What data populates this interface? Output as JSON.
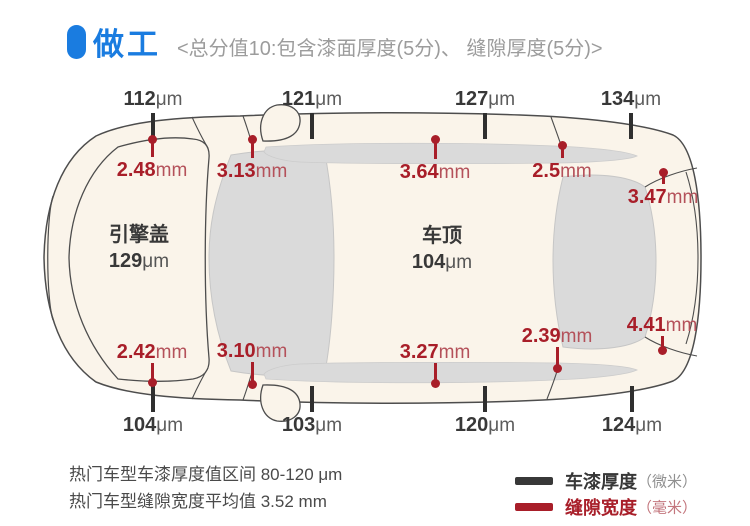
{
  "header": {
    "title": "做工",
    "subtitle": "<总分值10:包含漆面厚度(5分)、 缝隙厚度(5分)>"
  },
  "car": {
    "hood": {
      "name": "引擎盖",
      "value": "129",
      "unit": "μm"
    },
    "roof": {
      "name": "车顶",
      "value": "104",
      "unit": "μm"
    }
  },
  "measurements": {
    "paint_unit": "μm",
    "gap_unit": "mm",
    "paint_top": [
      {
        "value": "112",
        "x": 153
      },
      {
        "value": "121",
        "x": 312
      },
      {
        "value": "127",
        "x": 485
      },
      {
        "value": "134",
        "x": 631
      }
    ],
    "paint_bottom": [
      {
        "value": "104",
        "x": 153
      },
      {
        "value": "103",
        "x": 312
      },
      {
        "value": "120",
        "x": 485
      },
      {
        "value": "124",
        "x": 632
      }
    ],
    "gap_top": [
      {
        "value": "2.48",
        "x": 152,
        "dot_y": 139,
        "label_y": 159
      },
      {
        "value": "3.13",
        "x": 252,
        "dot_y": 139,
        "label_y": 160
      },
      {
        "value": "3.64",
        "x": 435,
        "dot_y": 139,
        "label_y": 161
      },
      {
        "value": "2.5",
        "x": 562,
        "dot_y": 145,
        "label_y": 160
      },
      {
        "value": "3.47",
        "x": 663,
        "dot_y": 172,
        "label_y": 186
      }
    ],
    "gap_bottom": [
      {
        "value": "2.42",
        "x": 152,
        "dot_y": 382,
        "label_y": 341
      },
      {
        "value": "3.10",
        "x": 252,
        "dot_y": 384,
        "label_y": 340
      },
      {
        "value": "3.27",
        "x": 435,
        "dot_y": 383,
        "label_y": 341
      },
      {
        "value": "2.39",
        "x": 557,
        "dot_y": 368,
        "label_y": 325
      },
      {
        "value": "4.41",
        "x": 662,
        "dot_y": 350,
        "label_y": 314
      }
    ]
  },
  "notes": [
    "热门车型车漆厚度值区间 80-120 μm",
    "热门车型缝隙宽度平均值 3.52 mm"
  ],
  "legend": [
    {
      "label": "车漆厚度",
      "unit": "（微米）"
    },
    {
      "label": "缝隙宽度",
      "unit": "（毫米）"
    }
  ],
  "colors": {
    "blue": "#1a7ce0",
    "red": "#a81e29",
    "black": "#383838",
    "car_fill": "#faf4ea",
    "window_fill": "#dadada"
  }
}
